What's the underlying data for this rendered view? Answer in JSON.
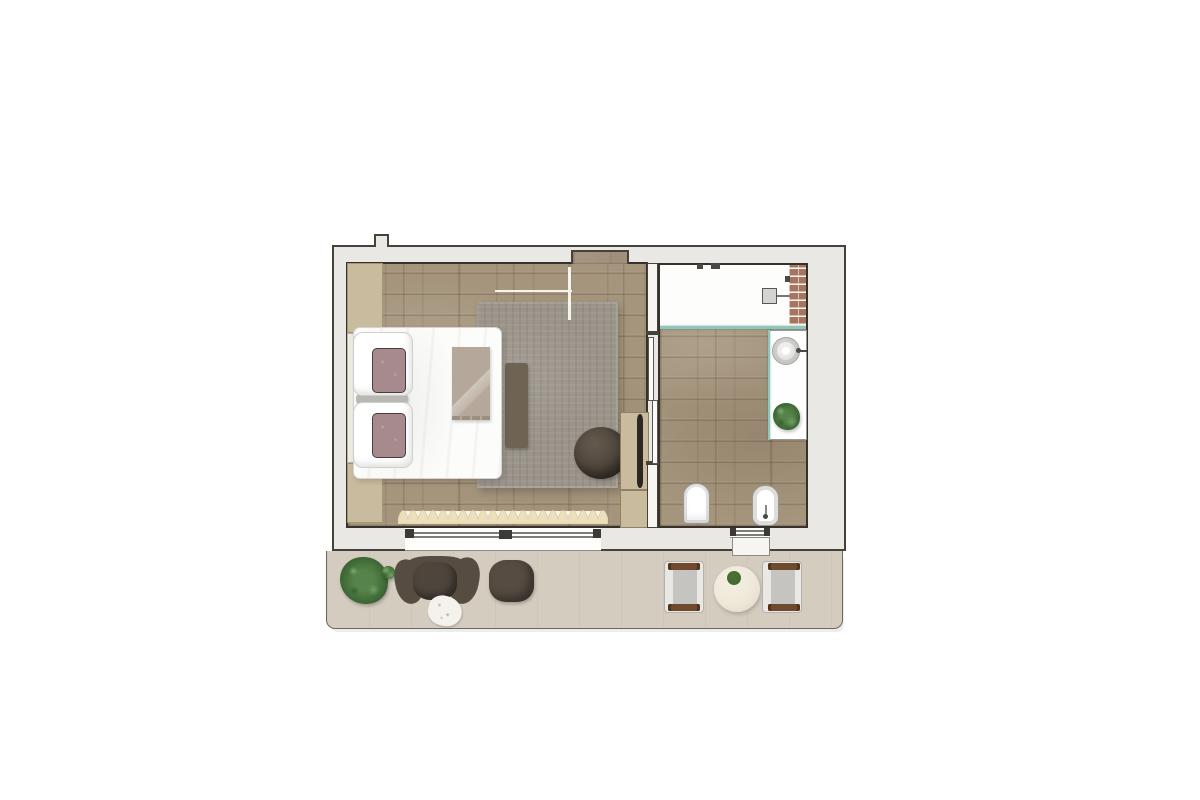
{
  "palette": {
    "wall-fill": "#e9e8e5",
    "wall-line": "#45423c",
    "inner-line": "#35322c",
    "wood": "#a5957d",
    "rug": "#9b948a",
    "balcony-floor": "#d5ccc0",
    "beige-cabinet": "#c9bc9e",
    "glass": "#8ec6bb",
    "brick": "#a8735f",
    "accent-pillow": "#a78a8d",
    "throw": "#b5a89a",
    "dark-furniture": "#564c41",
    "chair-wood": "#6f4a2e",
    "table-cream": "#efe8d9",
    "plant-green": "#3f6b33",
    "curtain": "#ebdfbc"
  },
  "plan": {
    "type": "apartment-floor-plan-top-view",
    "rooms": [
      {
        "id": "bedroom"
      },
      {
        "id": "bathroom"
      },
      {
        "id": "entry"
      },
      {
        "id": "balcony"
      }
    ],
    "furniture": {
      "bedroom": [
        "double-bed",
        "white-pillow",
        "white-pillow",
        "accent-pillow",
        "accent-pillow",
        "headboard-cabinet",
        "headboard-cabinet",
        "throw-blanket",
        "area-rug",
        "bench-runner",
        "lounge-pouf",
        "tv-cabinet",
        "tv",
        "curtain-valance"
      ],
      "bathroom": [
        "walk-in-shower",
        "rain-shower-head",
        "glass-partition",
        "tiled-wall-strip",
        "vanity-counter",
        "round-basin",
        "faucet",
        "counter-plant",
        "wall-hung-toilet",
        "bidet",
        "window-with-sill"
      ],
      "balcony": [
        "potted-plant",
        "lounge-chair",
        "sheepskin-side-table",
        "ottoman",
        "patio-chair",
        "round-side-table",
        "table-plant",
        "patio-chair"
      ]
    }
  }
}
